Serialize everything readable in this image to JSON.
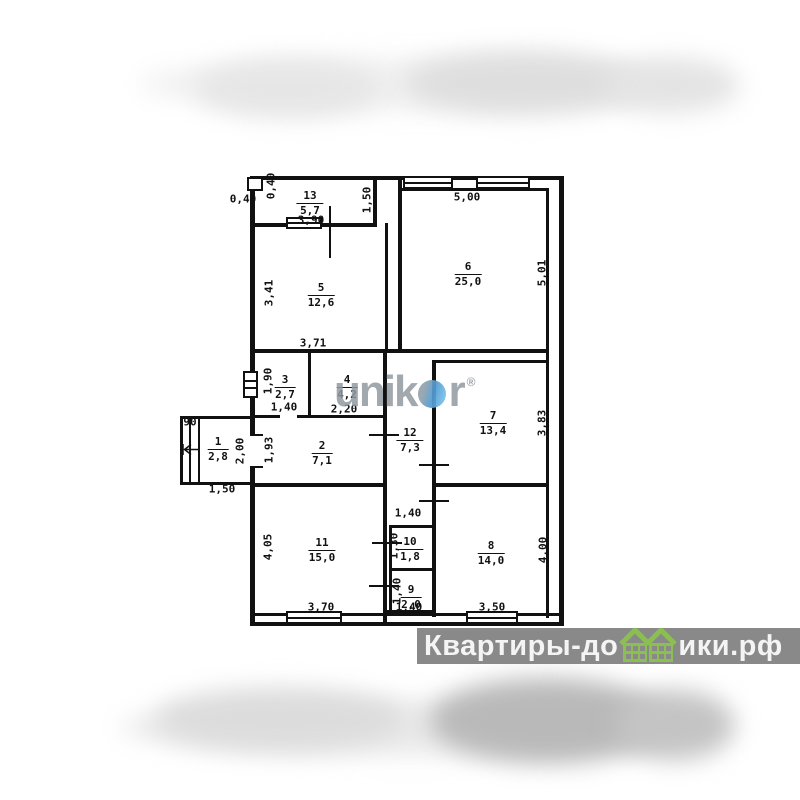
{
  "plan": {
    "rooms": [
      {
        "num": "13",
        "area": "5,7",
        "x": 310,
        "y": 190
      },
      {
        "num": "5",
        "area": "12,6",
        "x": 321,
        "y": 282
      },
      {
        "num": "6",
        "area": "25,0",
        "x": 468,
        "y": 261
      },
      {
        "num": "3",
        "area": "2,7",
        "x": 285,
        "y": 374
      },
      {
        "num": "4",
        "area": "4,2",
        "x": 347,
        "y": 374
      },
      {
        "num": "7",
        "area": "13,4",
        "x": 493,
        "y": 410
      },
      {
        "num": "1",
        "area": "2,8",
        "x": 218,
        "y": 436
      },
      {
        "num": "2",
        "area": "7,1",
        "x": 322,
        "y": 440
      },
      {
        "num": "12",
        "area": "7,3",
        "x": 410,
        "y": 427
      },
      {
        "num": "11",
        "area": "15,0",
        "x": 322,
        "y": 537
      },
      {
        "num": "10",
        "area": "1,8",
        "x": 410,
        "y": 536
      },
      {
        "num": "9",
        "area": "2,0",
        "x": 411,
        "y": 584
      },
      {
        "num": "8",
        "area": "14,0",
        "x": 491,
        "y": 540
      }
    ],
    "dims": [
      {
        "t": "0,40",
        "x": 243,
        "y": 199,
        "r": 0
      },
      {
        "t": "0,40",
        "x": 271,
        "y": 186,
        "r": 1
      },
      {
        "t": "3,90",
        "x": 311,
        "y": 220,
        "r": 0
      },
      {
        "t": "1,50",
        "x": 367,
        "y": 200,
        "r": 1
      },
      {
        "t": "5,00",
        "x": 467,
        "y": 197,
        "r": 0
      },
      {
        "t": "5,01",
        "x": 542,
        "y": 273,
        "r": 1
      },
      {
        "t": "3,41",
        "x": 269,
        "y": 293,
        "r": 1
      },
      {
        "t": "3,71",
        "x": 313,
        "y": 343,
        "r": 0
      },
      {
        "t": "1,90",
        "x": 268,
        "y": 381,
        "r": 1
      },
      {
        "t": "1,40",
        "x": 284,
        "y": 407,
        "r": 0
      },
      {
        "t": "2,20",
        "x": 344,
        "y": 409,
        "r": 0
      },
      {
        "t": "3,83",
        "x": 542,
        "y": 423,
        "r": 1
      },
      {
        "t": "90",
        "x": 190,
        "y": 422,
        "r": 0
      },
      {
        "t": "2,00",
        "x": 240,
        "y": 451,
        "r": 1
      },
      {
        "t": "1,93",
        "x": 269,
        "y": 450,
        "r": 1
      },
      {
        "t": "1,50",
        "x": 222,
        "y": 489,
        "r": 0
      },
      {
        "t": "1,40",
        "x": 408,
        "y": 513,
        "r": 0
      },
      {
        "t": "4,05",
        "x": 268,
        "y": 547,
        "r": 1
      },
      {
        "t": "3,70",
        "x": 321,
        "y": 607,
        "r": 0
      },
      {
        "t": "1,30",
        "x": 394,
        "y": 546,
        "r": 1
      },
      {
        "t": "1,40",
        "x": 397,
        "y": 591,
        "r": 1
      },
      {
        "t": "1,40",
        "x": 409,
        "y": 607,
        "r": 0
      },
      {
        "t": "4,00",
        "x": 543,
        "y": 550,
        "r": 1
      },
      {
        "t": "3,50",
        "x": 492,
        "y": 607,
        "r": 0
      }
    ]
  },
  "watermarks": {
    "unikor": {
      "left": "unik",
      "right": "r",
      "reg": "®",
      "circle_color": "#4e9bd4",
      "text_color": "#9199a0"
    },
    "bottom_bar": {
      "prefix": "Квартиры-до",
      "suffix": "ики.рф",
      "bar_color": "#898989",
      "text_color": "#f4f4f4",
      "house_color": "#8cbf52"
    }
  }
}
